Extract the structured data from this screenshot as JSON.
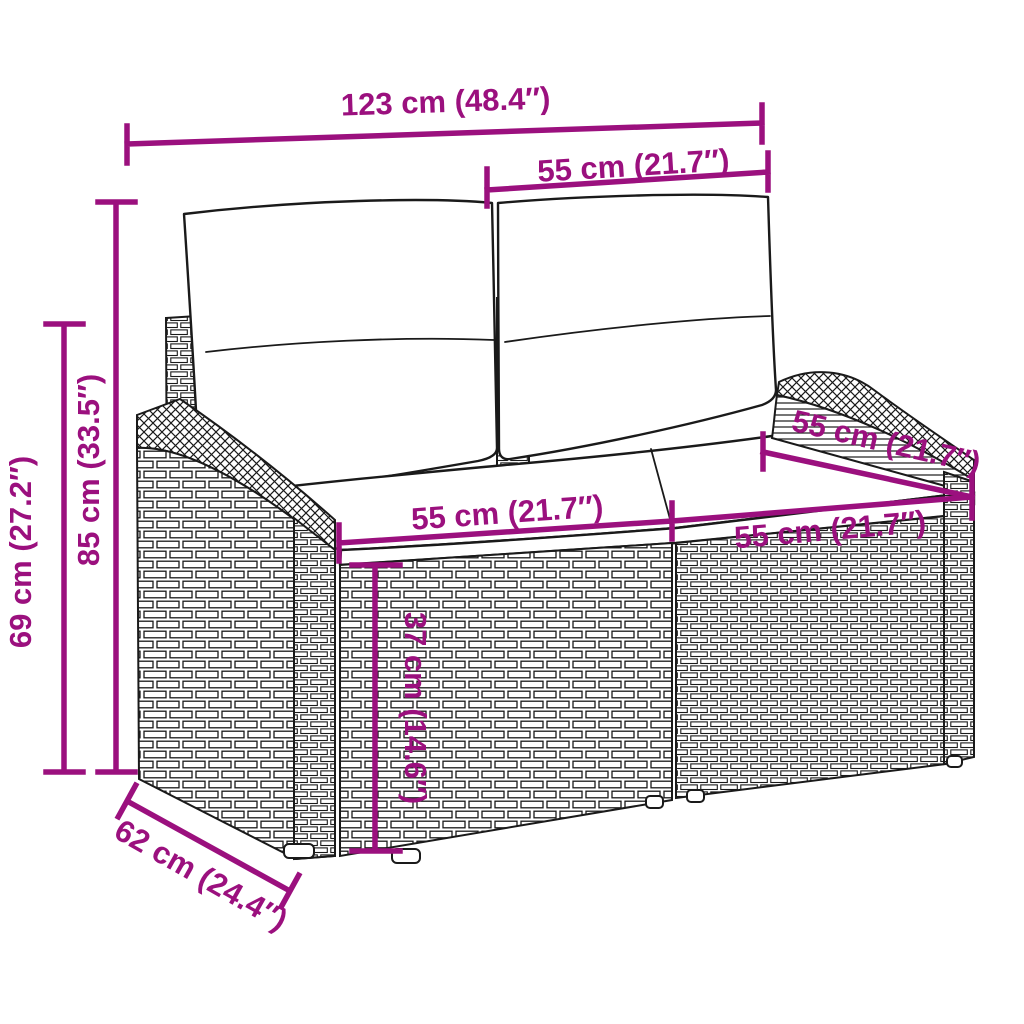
{
  "diagram": {
    "title": "Rattan garden loveseat with cushions - dimension diagram",
    "colors": {
      "dimension_annotation": "#9B107E",
      "line_art": "#1A1A1A",
      "background": "#FFFFFF"
    },
    "dimensions": {
      "overall_width": {
        "label": "123 cm (48.4″)",
        "value_cm": 123,
        "value_in": 48.4
      },
      "backrest_width": {
        "label": "55 cm (21.7″)",
        "value_cm": 55,
        "value_in": 21.7
      },
      "total_height": {
        "label": "85 cm (33.5″)",
        "value_cm": 85,
        "value_in": 33.5
      },
      "armrest_height": {
        "label": "69 cm (27.2″)",
        "value_cm": 69,
        "value_in": 27.2
      },
      "seat_depth": {
        "label": "55 cm (21.7″)",
        "value_cm": 55,
        "value_in": 21.7
      },
      "seat_width_left": {
        "label": "55 cm (21.7″)",
        "value_cm": 55,
        "value_in": 21.7
      },
      "seat_width_right": {
        "label": "55 cm (21.7″)",
        "value_cm": 55,
        "value_in": 21.7
      },
      "seat_height": {
        "label": "37 cm (14.6″)",
        "value_cm": 37,
        "value_in": 14.6
      },
      "base_depth": {
        "label": "62 cm (24.4″)",
        "value_cm": 62,
        "value_in": 24.4
      }
    }
  }
}
